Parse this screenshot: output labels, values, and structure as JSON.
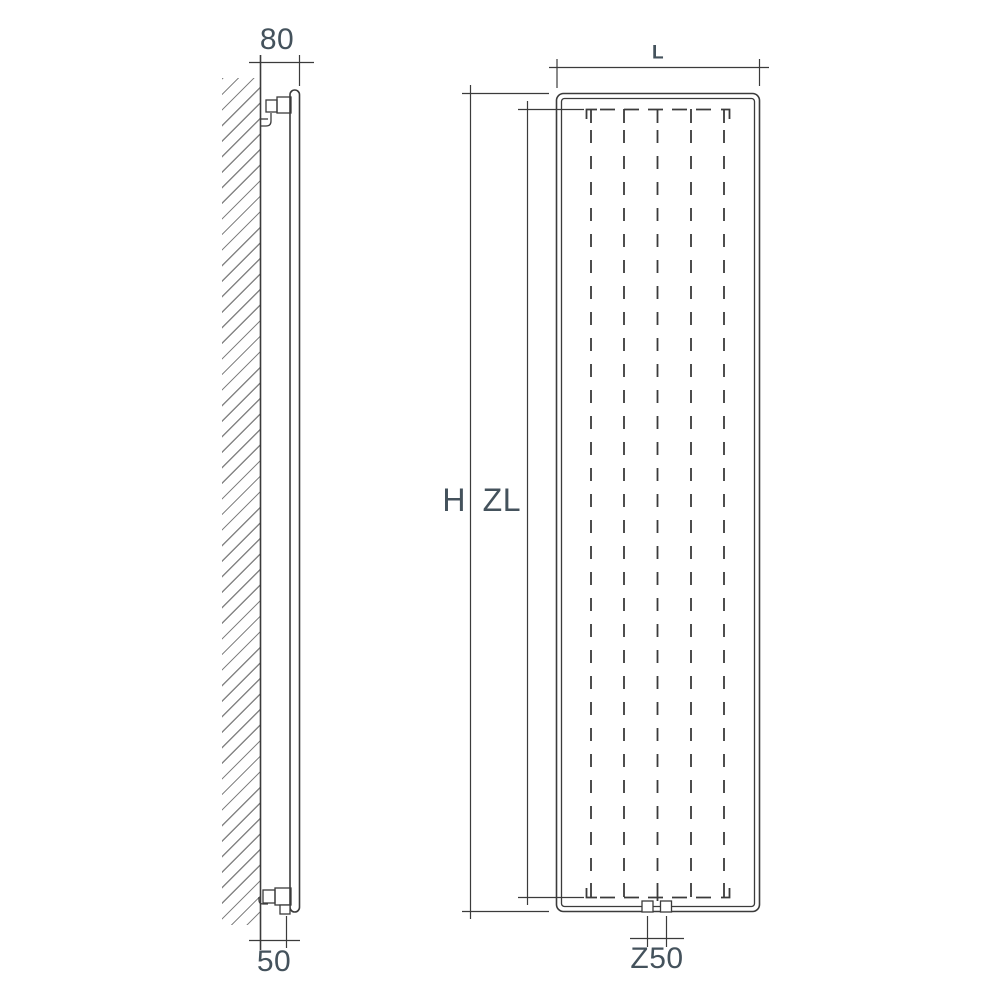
{
  "drawing": {
    "dimensions": {
      "wall_offset_top": "80",
      "wall_offset_bottom": "50",
      "width": "L",
      "height": "H",
      "element_height": "ZL",
      "connection_spacing": "Z50"
    },
    "colors": {
      "line": "#3b3b3b",
      "text": "#44525c",
      "hatch": "#858585",
      "background": "#ffffff"
    }
  }
}
